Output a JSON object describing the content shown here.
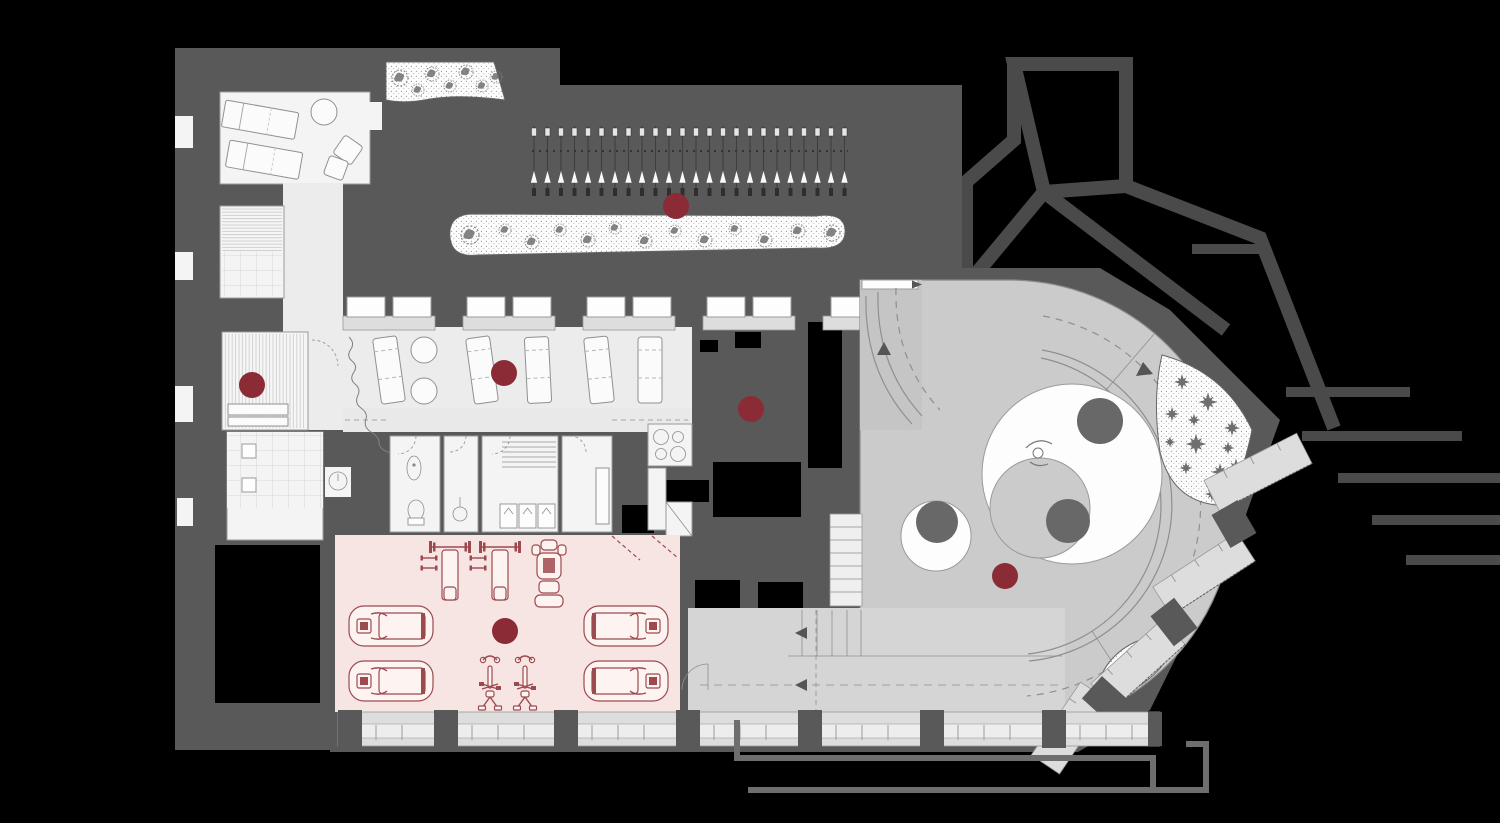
{
  "colors": {
    "background": "#000000",
    "wall": "#595959",
    "context": "#4a4a4a",
    "room": "#f4f4f4",
    "room_dim": "#ececec",
    "corridor_floor": "#e9e9e9",
    "platform": "#cbcbcb",
    "corridor_strip": "#c5c5c5",
    "walkway": "#d5d5d5",
    "terrace": "#dddddd",
    "white": "#fdfdfd",
    "circle_dark": "#686868",
    "line": "#8f8f8f",
    "plant": "#6e6e6e",
    "gym": "#f7e5e3",
    "equipment": "#9d4a4f",
    "equipment_fill": "#fdf4f2",
    "marker": "#8b2b35",
    "step_arrow": "#555555"
  },
  "markers": {
    "radius": 13,
    "points": [
      {
        "id": "sauna",
        "x": 252,
        "y": 385
      },
      {
        "id": "vine-walk",
        "x": 676,
        "y": 206
      },
      {
        "id": "lounge",
        "x": 504,
        "y": 373
      },
      {
        "id": "courtyard",
        "x": 751,
        "y": 409
      },
      {
        "id": "gym",
        "x": 505,
        "y": 631
      },
      {
        "id": "ramp-terrace",
        "x": 1005,
        "y": 576
      }
    ]
  },
  "planting": {
    "vine_columns": 24,
    "path_band_trees": 13,
    "garden_trees": 7,
    "star_plants_upper": 12,
    "star_plants_lower": 8
  },
  "figures": {
    "person_count": 1
  }
}
